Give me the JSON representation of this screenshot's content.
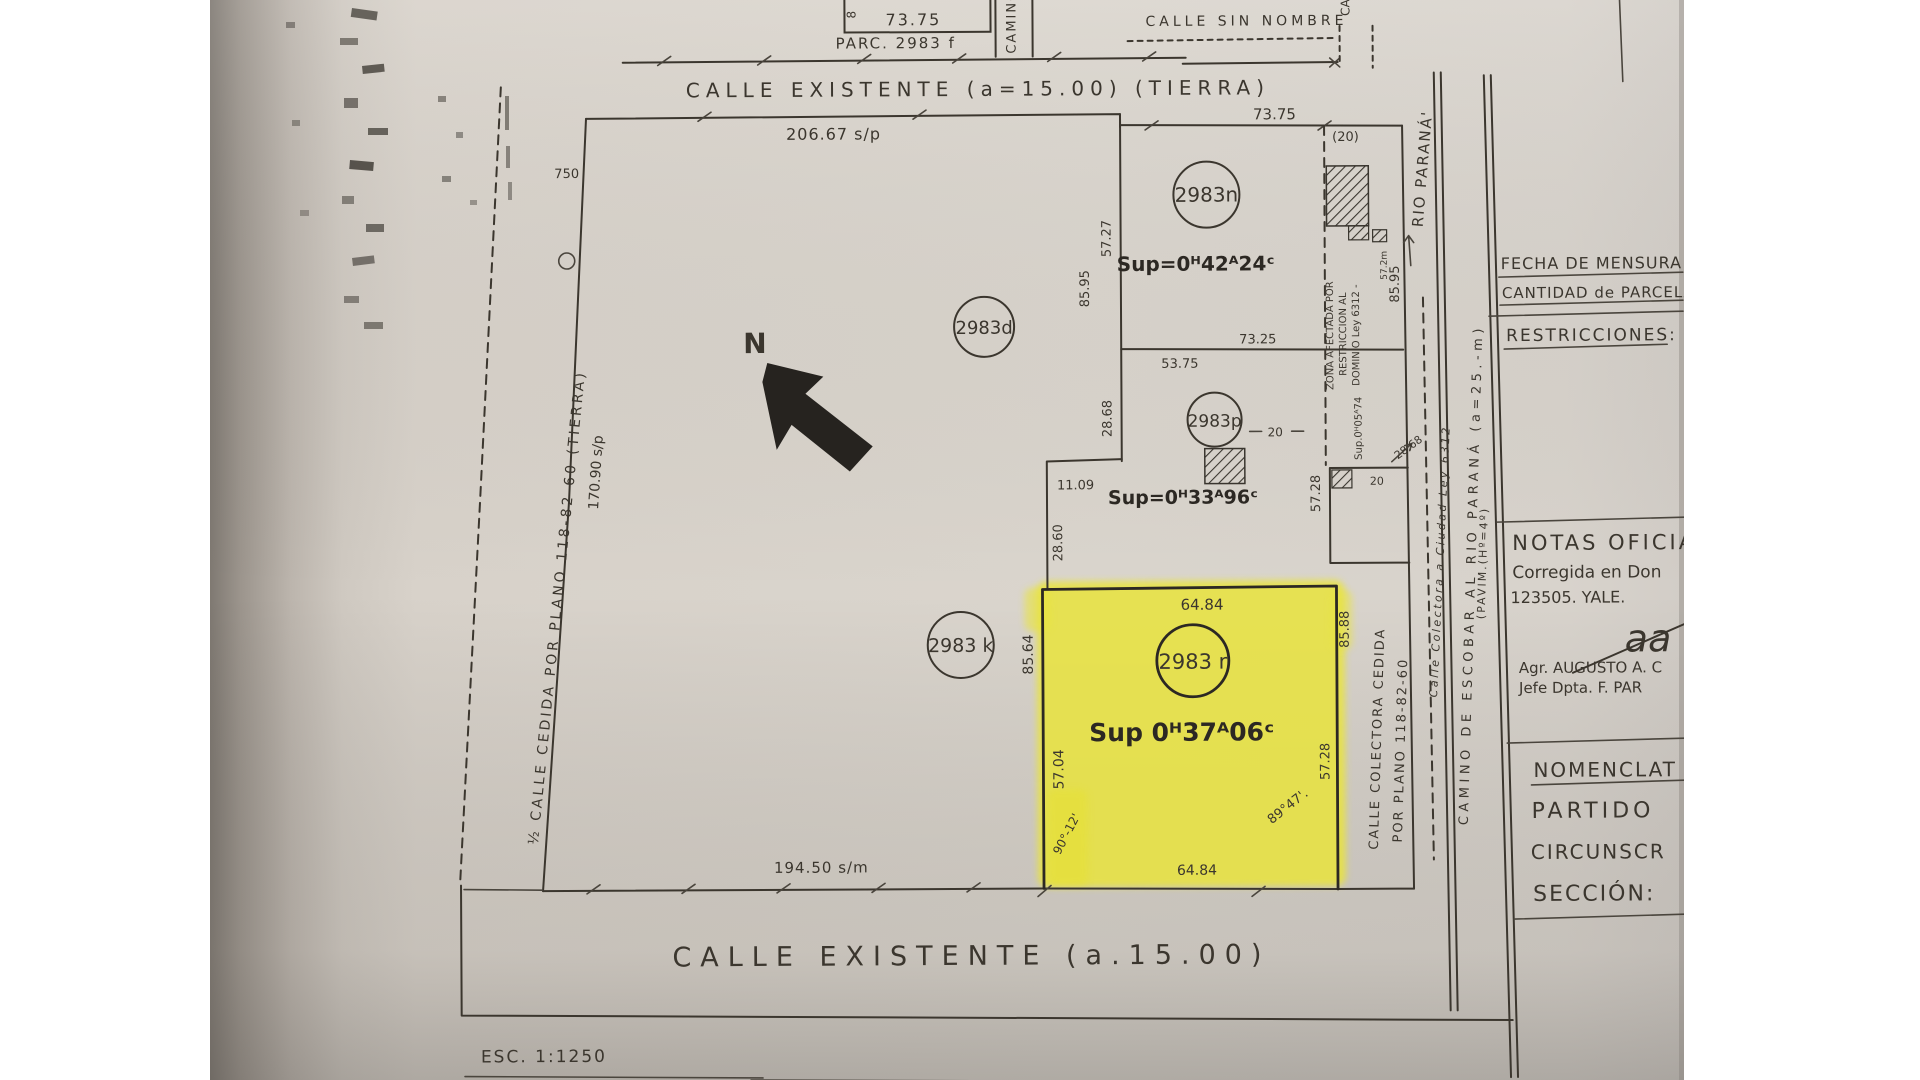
{
  "colors": {
    "paper": "#d8d2ca",
    "ink": "#3b362e",
    "ink_dark": "#26231f",
    "yellow": "#eae43e",
    "page_bg": "#ffffff"
  },
  "top_area": {
    "box_dim": "73.75",
    "box_side": "8",
    "parc_label": "PARC. 2983 f",
    "camino_v": "CAMINO",
    "calle_sin_nombre": "CALLE SIN NOMBRE",
    "camino_v2": "CA",
    "calle_top": "CALLE EXISTENTE (a=15.00) (TIERRA)",
    "exp": "EXP. DE APROBACI"
  },
  "block": {
    "top_dim": "206.67 s/p",
    "left_w": "750",
    "left_dim": "170.90 s/p",
    "left_street": "½ CALLE CEDIDA POR PLANO 118-82-60 (TIERRA)",
    "bottom_dim": "194.50 s/m",
    "north": "N"
  },
  "parcel_d": {
    "id": "2983d"
  },
  "parcel_k": {
    "id": "2983 k"
  },
  "parcel_n": {
    "id": "2983n",
    "sup": "Sup=0ᴴ42ᴬ24ᶜ",
    "top_dim": "73.75",
    "strip_w": "(20)",
    "side_a": "57.27",
    "side_b": "85.95",
    "side_right": "85.95",
    "bottom_dim": "73.25",
    "zona_1": "ZONA AFECTADA POR",
    "zona_2": "RESTRICCION AL",
    "zona_3": "DOMINIO Ley 6312 -",
    "zona_small": "57.2m"
  },
  "parcel_p": {
    "id": "2983p",
    "sup": "Sup=0ᴴ33ᴬ96ᶜ",
    "top_dim": "53.75",
    "dash_dim": "20",
    "side_left": "28.68",
    "jog_dim": "11.09",
    "side_left2": "28.60",
    "side_right": "57.28",
    "sub_sup": "Sup.0ᴴ05ᴬ74",
    "sub_w": "20",
    "sub_len": "28.68"
  },
  "parcel_r": {
    "id": "2983 r",
    "sup": "Sup 0ᴴ37ᴬ06ᶜ",
    "top_dim": "64.84",
    "bottom_dim": "64.84",
    "left_a": "85.64",
    "left_b": "57.04",
    "right_a": "85.88",
    "right_b": "57.28",
    "angle_bl": "90°-12'",
    "angle_br": "89°47'."
  },
  "right_road": {
    "rio": "RIO PARANÁ'",
    "camino": "CAMINO DE ESCOBAR AL RIO PARANÁ (a=25.-m)",
    "pavim": "(PAVIM.(Hº=4º)",
    "colectora_1": "CALLE COLECTORA CEDIDA",
    "colectora_2": "POR PLANO 118-82-60",
    "colectora_it": "Calle Colectora a Ciudad Ley 6312"
  },
  "bottom_area": {
    "calle": "CALLE EXISTENTE (a.15.00)",
    "esc": "ESC. 1:1250"
  },
  "titleblock": {
    "fecha": "FECHA DE MENSURA",
    "cantidad": "CANTIDAD de PARCELA",
    "restricciones": "RESTRICCIONES:",
    "notas_title": "NOTAS OFICIAL",
    "notas_line1": "Corregida en Don",
    "notas_line2": "123505. YALE.",
    "firma": "aa",
    "agr": "Agr. AUGUSTO A. C",
    "jefe": "Jefe Dpta. F. PAR",
    "nomenclat": "NOMENCLAT",
    "partido": "PARTIDO",
    "circunscr": "CIRCUNSCR",
    "seccion": "SECCIÓN:"
  }
}
